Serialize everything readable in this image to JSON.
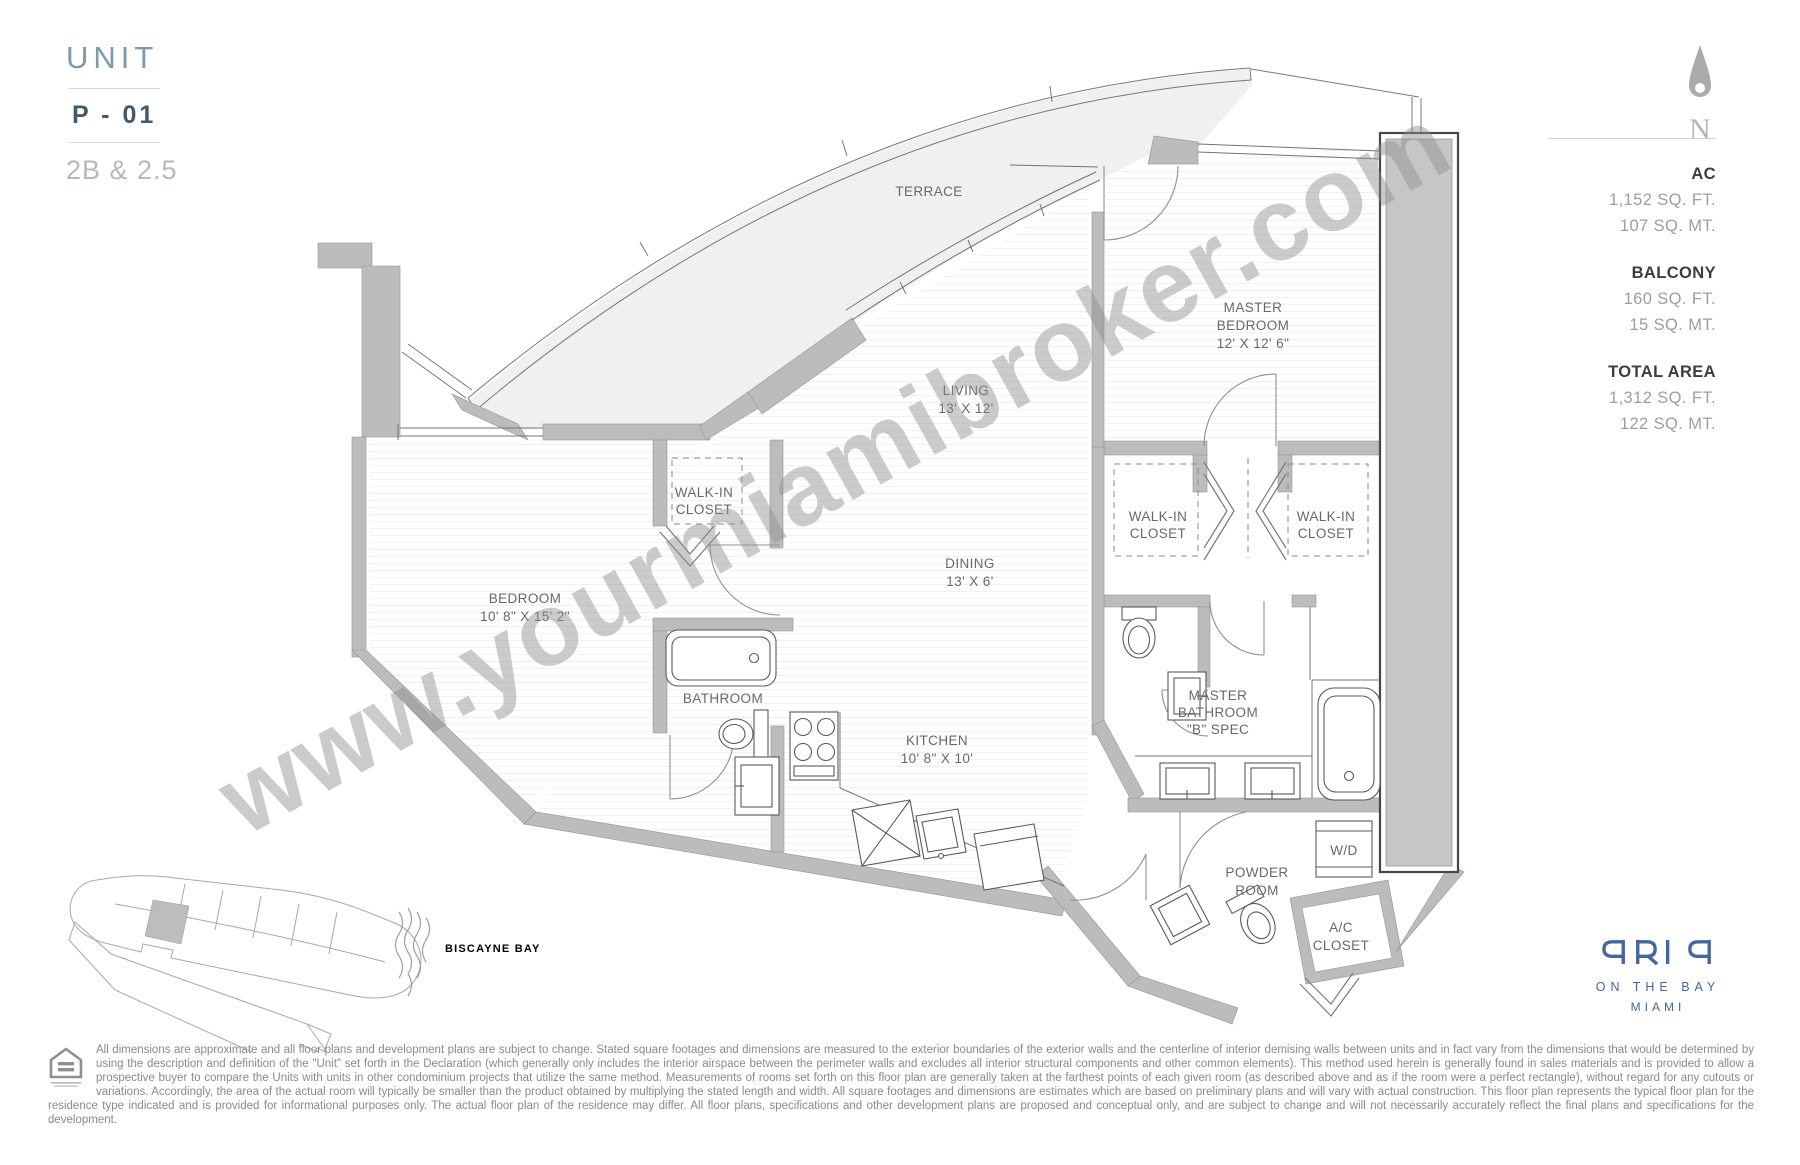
{
  "unit": {
    "title": "UNIT",
    "number": "P - 01",
    "type": "2B & 2.5"
  },
  "compass": {
    "n": "N"
  },
  "stats": {
    "items": [
      {
        "label": "AC",
        "ft": "1,152 SQ. FT.",
        "mt": "107 SQ. MT."
      },
      {
        "label": "BALCONY",
        "ft": "160 SQ. FT.",
        "mt": "15 SQ. MT."
      },
      {
        "label": "TOTAL AREA",
        "ft": "1,312 SQ. FT.",
        "mt": "122 SQ. MT."
      }
    ]
  },
  "rooms": {
    "terrace": [
      "TERRACE"
    ],
    "living": [
      "LIVING",
      "13' X 12'"
    ],
    "master_bedroom": [
      "MASTER",
      "BEDROOM",
      "12' X 12' 6\""
    ],
    "walk_in_closet": [
      "WALK-IN",
      "CLOSET"
    ],
    "dining": [
      "DINING",
      "13' X 6'"
    ],
    "bedroom": [
      "BEDROOM",
      "10' 8\" X 15' 2\""
    ],
    "bathroom": [
      "BATHROOM"
    ],
    "kitchen": [
      "KITCHEN",
      "10' 8\" X 10'"
    ],
    "master_bathroom": [
      "MASTER",
      "BATHROOM",
      "\"B\" SPEC"
    ],
    "wd": [
      "W/D"
    ],
    "powder_room": [
      "POWDER",
      "ROOM"
    ],
    "ac_closet": [
      "A/C",
      "CLOSET"
    ]
  },
  "watermark": {
    "text": "www.yourmiamibroker.com"
  },
  "keyplan": {
    "label": "BISCAYNE BAY"
  },
  "logo": {
    "name": "ARIA",
    "tagline": "ON THE BAY",
    "city": "MIAMI"
  },
  "disclaimer": {
    "text": "All dimensions are approximate and all floor plans and development plans are subject to change. Stated square footages and dimensions are measured to the exterior boundaries of the exterior walls and the centerline of interior demising walls between units and in fact vary from the dimensions that would be determined by using the description and definition of the \"Unit\" set forth in the Declaration (which generally only includes the interior airspace between the perimeter walls and excludes all interior structural components and other common elements). This method used herein is generally found in sales materials and is provided to allow a prospective buyer to compare the Units with units in other condominium projects that utilize the same method. Measurements of rooms set forth on this floor plan are generally taken at the farthest points of each given room (as described above and as if the room were a perfect rectangle), without regard for any cutouts or variations. Accordingly, the area of the actual room will typically be smaller than the product obtained by multiplying the stated length and width. All square footages and dimensions are estimates which are based on preliminary plans and will vary with actual construction. This floor plan represents the typical floor plan for the residence type indicated and is provided for informational purposes only. The actual floor plan of the residence may differ. All floor plans, specifications and other development plans are proposed and conceptual only, and are subject to change and will not necessarily accurately reflect the final plans and specifications for the development."
  }
}
